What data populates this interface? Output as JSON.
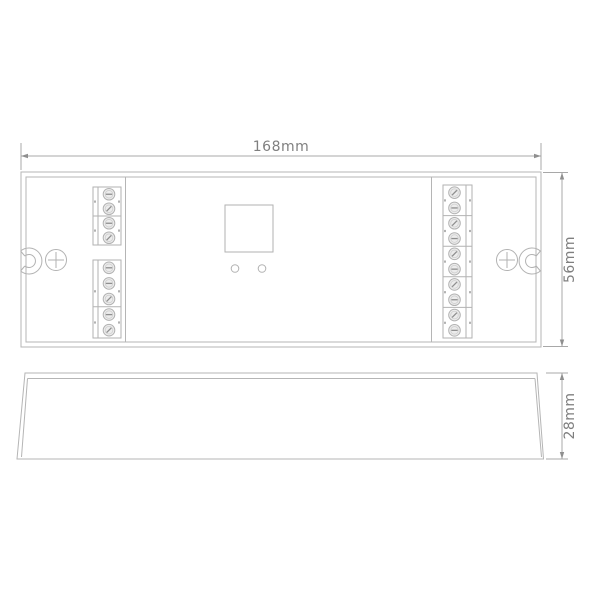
{
  "drawing": {
    "type": "mechanical-dimension-drawing",
    "views": [
      "top",
      "side"
    ]
  },
  "dimension_labels": {
    "width": "168mm",
    "height": "56mm",
    "depth": "28mm"
  },
  "colors": {
    "background": "#ffffff",
    "body_line": "#b5b5b5",
    "dimension_line": "#a8a8a8",
    "text": "#7f7f7f",
    "screw_fill": "#ececec",
    "slot_line": "#8f8f8f"
  },
  "terminals": {
    "left": {
      "groups": [
        {
          "cells": [
            [
              "flat",
              "diag"
            ],
            [
              "flat",
              "diag"
            ]
          ]
        },
        {
          "cells": [
            [
              "flat",
              "flat",
              "diag"
            ],
            [
              "flat",
              "diag"
            ]
          ]
        }
      ]
    },
    "right": {
      "groups": [
        {
          "cells": [
            [
              "diag",
              "flat"
            ],
            [
              "diag",
              "flat"
            ],
            [
              "diag",
              "flat"
            ],
            [
              "diag",
              "flat"
            ],
            [
              "diag",
              "flat"
            ]
          ]
        }
      ]
    }
  }
}
